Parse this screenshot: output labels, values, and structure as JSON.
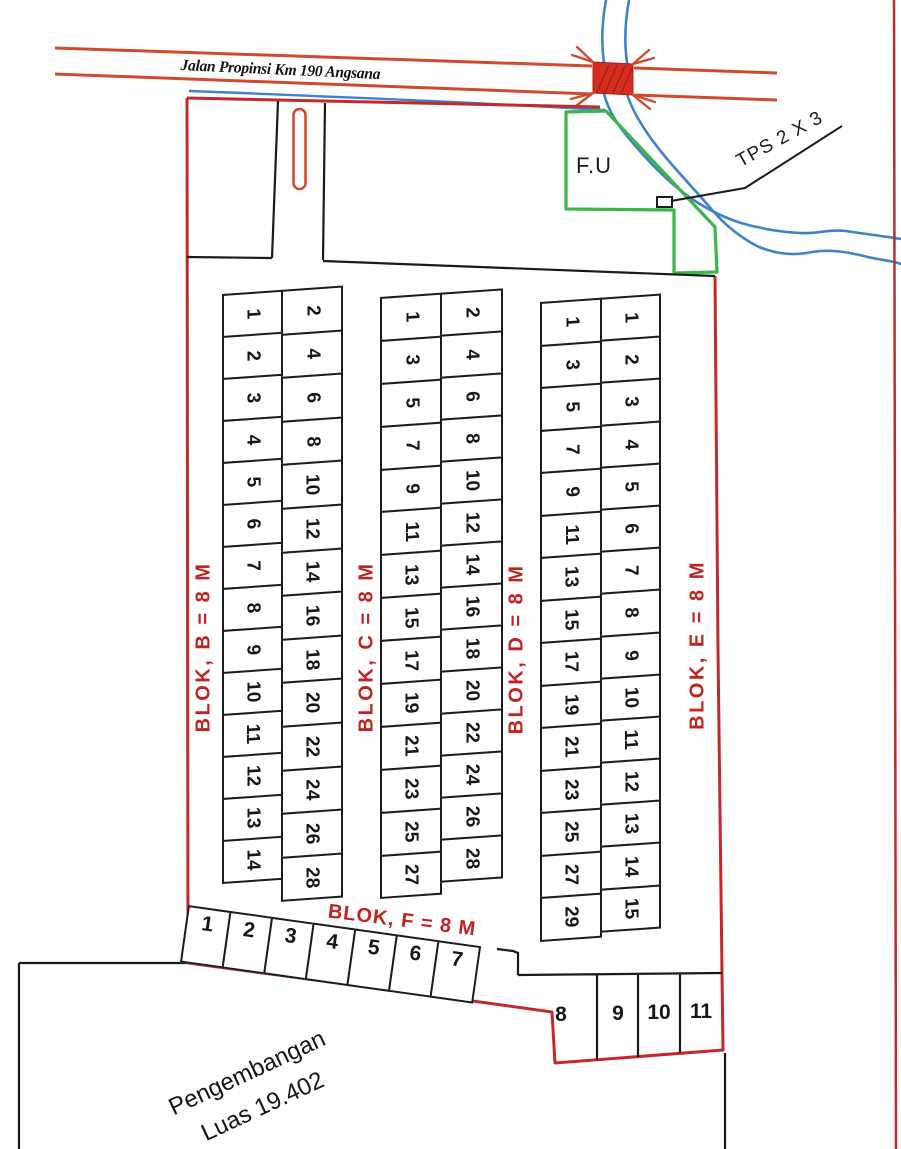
{
  "road": {
    "label": "Jalan Propinsi Km 190 Angsana"
  },
  "facility": {
    "label": "F.U"
  },
  "tps": {
    "label": "TPS 2 X 3"
  },
  "development": {
    "line1": "Pengembangan",
    "line2": "Luas 19.402"
  },
  "blocks": {
    "b": {
      "label": "BLOK, B = 8 M",
      "col1": [
        1,
        2,
        3,
        4,
        5,
        6,
        7,
        8,
        9,
        10,
        11,
        12,
        13,
        14
      ],
      "col2": [
        2,
        4,
        6,
        8,
        10,
        12,
        14,
        16,
        18,
        20,
        22,
        24,
        26,
        28
      ]
    },
    "c": {
      "label": "BLOK, C = 8 M",
      "col1": [
        1,
        3,
        5,
        7,
        9,
        11,
        13,
        15,
        17,
        19,
        21,
        23,
        25,
        27
      ],
      "col2": [
        2,
        4,
        6,
        8,
        10,
        12,
        14,
        16,
        18,
        20,
        22,
        24,
        26,
        28
      ]
    },
    "d": {
      "label": "BLOK, D = 8 M",
      "col1": [
        1,
        3,
        5,
        7,
        9,
        11,
        13,
        15,
        17,
        19,
        21,
        23,
        25,
        27,
        29
      ]
    },
    "e": {
      "label": "BLOK, E = 8 M",
      "col1": [
        1,
        2,
        3,
        4,
        5,
        6,
        7,
        8,
        9,
        10,
        11,
        12,
        13,
        14,
        15
      ]
    },
    "f": {
      "label": "BLOK, F = 8 M",
      "row1": [
        1,
        2,
        3,
        4,
        5,
        6,
        7
      ],
      "row2": [
        8,
        9,
        10,
        11
      ]
    }
  },
  "colors": {
    "boundary_red": "#c4282b",
    "road_red": "#cf4a2e",
    "bridge_red": "#d62d20",
    "river_blue": "#3f82cc",
    "facility_green": "#3cb54a",
    "line_black": "#1a1a1a",
    "label_red": "#c3231f"
  }
}
